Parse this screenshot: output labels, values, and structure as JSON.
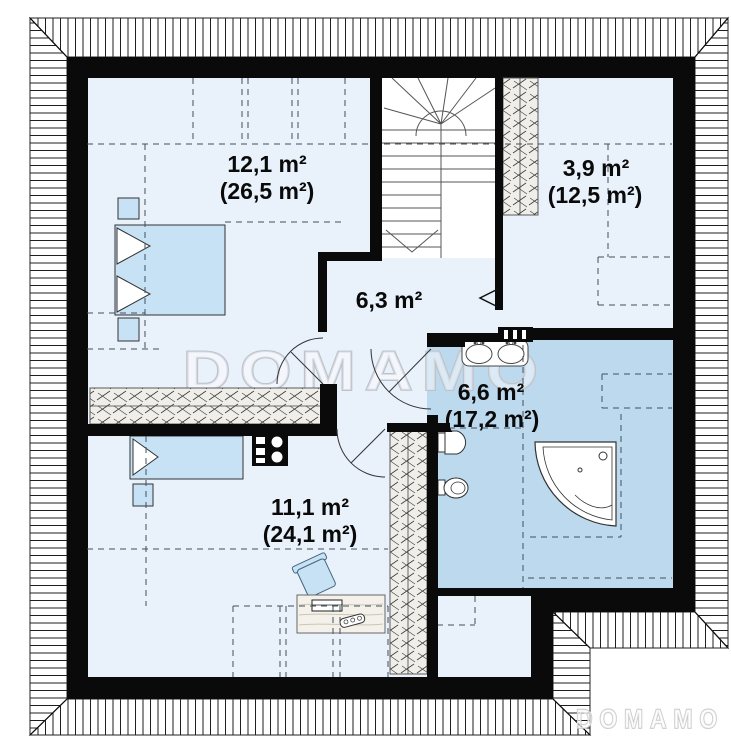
{
  "watermark": {
    "main": "DOMAMO",
    "corner": "DOMAMO"
  },
  "rooms": [
    {
      "name": "bedroom-top-left",
      "area": "12,1 m²",
      "area_total": "(26,5 m²)"
    },
    {
      "name": "room-top-right",
      "area": "3,9 m²",
      "area_total": "(12,5 m²)"
    },
    {
      "name": "hall",
      "area": "6,3 m²",
      "area_total": ""
    },
    {
      "name": "bathroom",
      "area": "6,6 m²",
      "area_total": "(17,2 m²)"
    },
    {
      "name": "bedroom-bottom",
      "area": "11,1 m²",
      "area_total": "(24,1 m²)"
    }
  ],
  "colors": {
    "floor": "#e9f1fb",
    "bathroom_floor": "#bcd9ee",
    "wall": "#0a0a0a",
    "furniture": "#c7e2f5",
    "wardrobe": "#efeee9",
    "stair_bg": "#ffffff",
    "watermark": "#c3c9cf",
    "dashed": "#42505e",
    "label_text": "#0a0a0a"
  }
}
